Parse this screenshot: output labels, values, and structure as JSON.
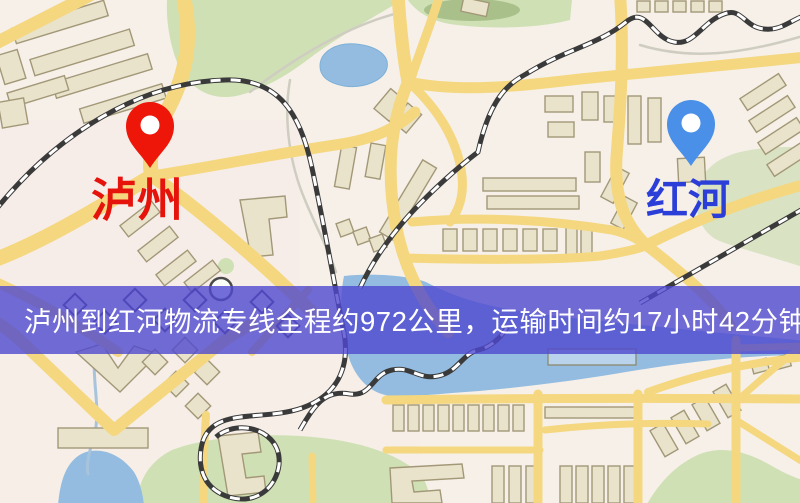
{
  "map": {
    "origin_marker": {
      "label": "泸州",
      "pin_color": "#ee1509",
      "label_color": "#e6130c"
    },
    "destination_marker": {
      "label": "红河",
      "pin_color": "#4a90e8",
      "label_color": "#2b3fd8"
    },
    "caption_banner": {
      "text": "泸州到红河物流专线全程约972公里，运输时间约17小时42分钟.",
      "background_color": "#4f48cf",
      "text_color": "#ffffff"
    },
    "palette": {
      "background": "#f6f0e8",
      "road": "#f4d77f",
      "building_fill": "#eae3cb",
      "building_outline": "#a29878",
      "park_green": "#cfe0b4",
      "water_blue": "#93bce0",
      "railway_dark": "#3a3a3a"
    }
  }
}
